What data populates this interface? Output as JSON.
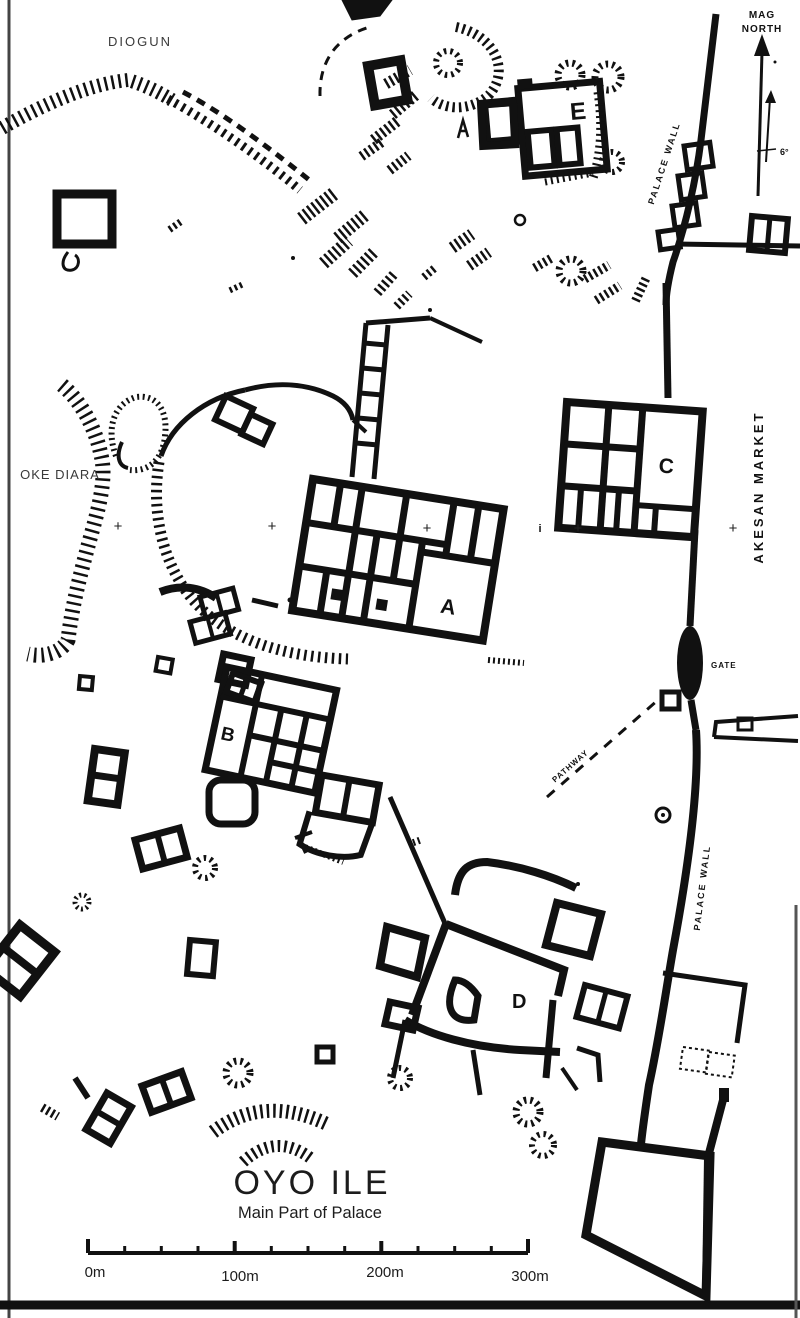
{
  "map": {
    "title": "OYO ILE",
    "subtitle": "Main Part of Palace",
    "regions": {
      "diogun": "DIOGUN",
      "oke_diara": "OKE DIARA",
      "akesan_market": "AKESAN MARKET"
    },
    "walls": {
      "palace_wall_upper": "PALACE WALL",
      "palace_wall_lower": "PALACE WALL",
      "gate": "GATE",
      "pathway": "PATHWAY"
    },
    "compounds": {
      "a": "A",
      "b": "B",
      "c": "C",
      "d": "D",
      "e": "E"
    },
    "north": {
      "line1": "MAG",
      "line2": "NORTH",
      "declination": "6°"
    },
    "scale": {
      "t0": "0m",
      "t100": "100m",
      "t200": "200m",
      "t300": "300m"
    },
    "marks": {
      "cross": "+",
      "info": "i"
    },
    "colors": {
      "ink": "#111111",
      "paper": "#ffffff",
      "muted": "#3a3a3a"
    }
  }
}
